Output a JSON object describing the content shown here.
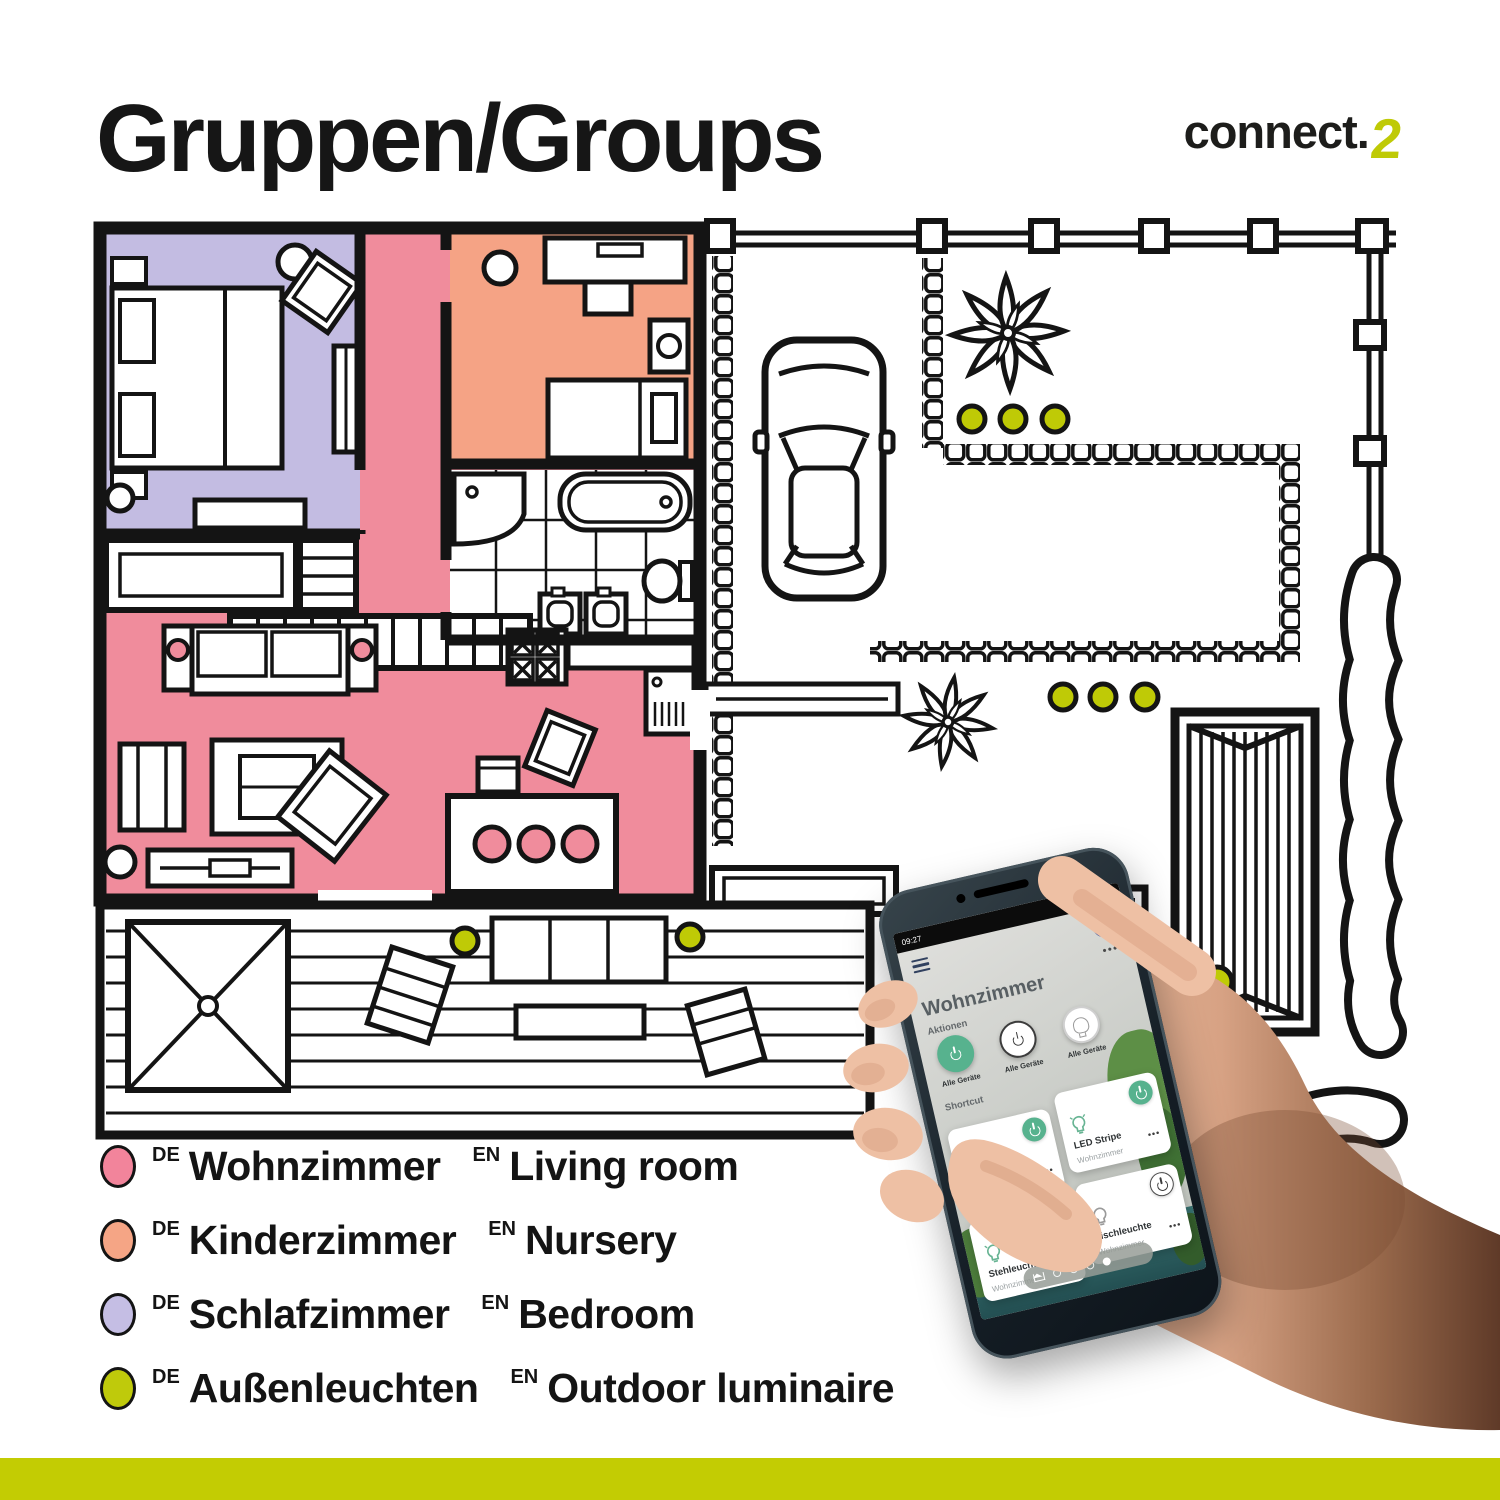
{
  "header": {
    "title": "Gruppen/Groups",
    "logo": {
      "text": "connect.",
      "accent": "2"
    }
  },
  "colors": {
    "wohnzimmer": "#F08C9C",
    "kinderzimmer": "#F5A385",
    "schlafzimmer": "#C3BCE2",
    "aussenleuchten": "#BFCA06",
    "bar": "#C3CC03",
    "app_green": "#57B28E",
    "wall": "#141414"
  },
  "legend": {
    "de_tag": "DE",
    "en_tag": "EN",
    "items": [
      {
        "color": "#F2849B",
        "de": "Wohnzimmer",
        "en": "Living room"
      },
      {
        "color": "#F5A585",
        "de": "Kinderzimmer",
        "en": "Nursery"
      },
      {
        "color": "#C5BEE4",
        "de": "Schlafzimmer",
        "en": "Bedroom"
      },
      {
        "color": "#BFCA0B",
        "de": "Außenleuchten",
        "en": "Outdoor luminaire"
      }
    ]
  },
  "phone": {
    "status": {
      "time": "09:27",
      "battery": "95%"
    },
    "plus_label": "+",
    "more_label": "•••",
    "title": "Wohnzimmer",
    "actions_label": "Aktionen",
    "actions": [
      {
        "label": "Alle Geräte",
        "state": "on"
      },
      {
        "label": "Alle Geräte",
        "state": "outline"
      },
      {
        "label": "Alle Geräte",
        "state": "lamp"
      }
    ],
    "shortcut_label": "Shortcut",
    "cards": [
      {
        "name": "Deckenleuchte",
        "room": "Wohnzimmer",
        "state": "on",
        "more": "•••"
      },
      {
        "name": "LED Stripe",
        "room": "Wohnzimmer",
        "state": "on",
        "more": "•••"
      },
      {
        "name": "Stehleuchte",
        "room": "Wohnzimmer",
        "state": "on",
        "more": "•••"
      },
      {
        "name": "Tischleuchte",
        "room": "Wohnzimmer",
        "state": "off",
        "more": "•••"
      }
    ]
  }
}
